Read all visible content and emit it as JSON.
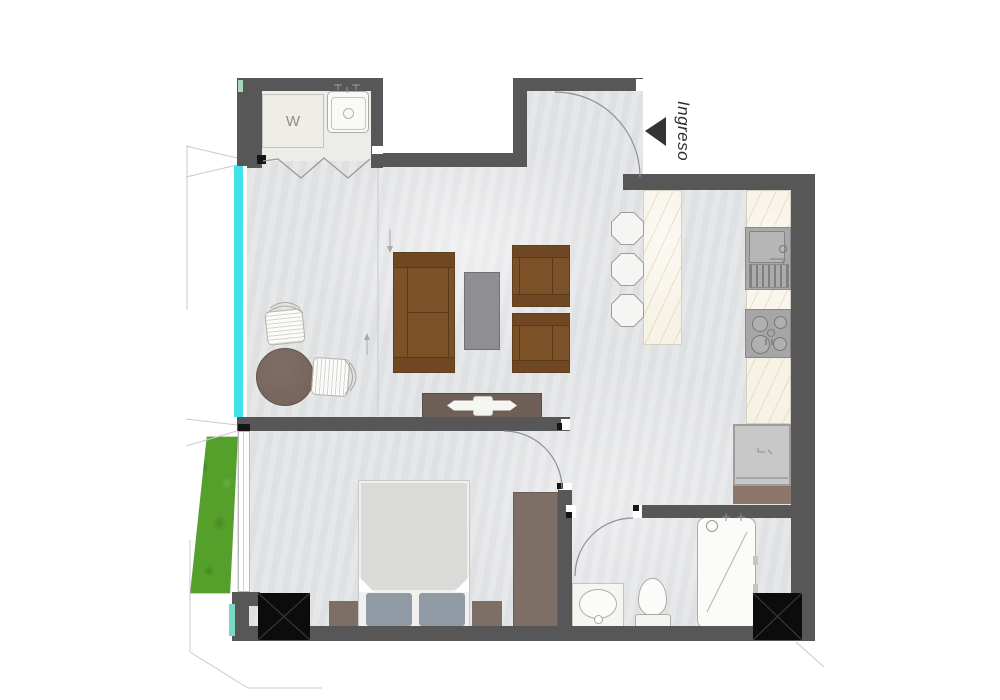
{
  "labels": {
    "entrance": "Ingreso",
    "washer": "W"
  },
  "palette": {
    "wall": "#575757",
    "floor": "#e3e4e6",
    "floor-laundry": "#ecece9",
    "glass": "#3fe2e8",
    "planter": "#55a02b",
    "shaft": "#0c0c0c",
    "marble": "#f7f2e6",
    "sofa": "#7d5128",
    "sofa-band": "#6f4723",
    "sofa-dark": "#5e3f1e",
    "wood": "#7d6f66",
    "cabinet": "#8b7669",
    "console": "#6e6057",
    "gray-table": "#8f8f91",
    "bed": "#f0f0ee",
    "blanket": "#dadbd9",
    "pillow": "#909ba5",
    "fixture": "#fbfbf9",
    "fixture-line": "#aeaca2",
    "appliance": "#a9a9a9",
    "fridge": "#c8c8c8",
    "text": "#2e2e2e"
  },
  "areas": [
    "entry-vestibule",
    "kitchen",
    "living-room",
    "dining-area",
    "laundry-closet",
    "bedroom",
    "bathroom",
    "balcony-planter"
  ],
  "fixtures": [
    "washer",
    "laundry-sink",
    "entry-door",
    "kitchen-island",
    "bar-stool",
    "kitchen-counter",
    "kitchen-sink",
    "cooktop",
    "refrigerator",
    "sofa",
    "armchair",
    "coffee-table",
    "tv-console",
    "dining-table",
    "dining-chair",
    "bed",
    "pillow",
    "nightstand",
    "wardrobe",
    "bathroom-vanity",
    "toilet",
    "bathtub",
    "service-shaft",
    "window",
    "planter"
  ]
}
